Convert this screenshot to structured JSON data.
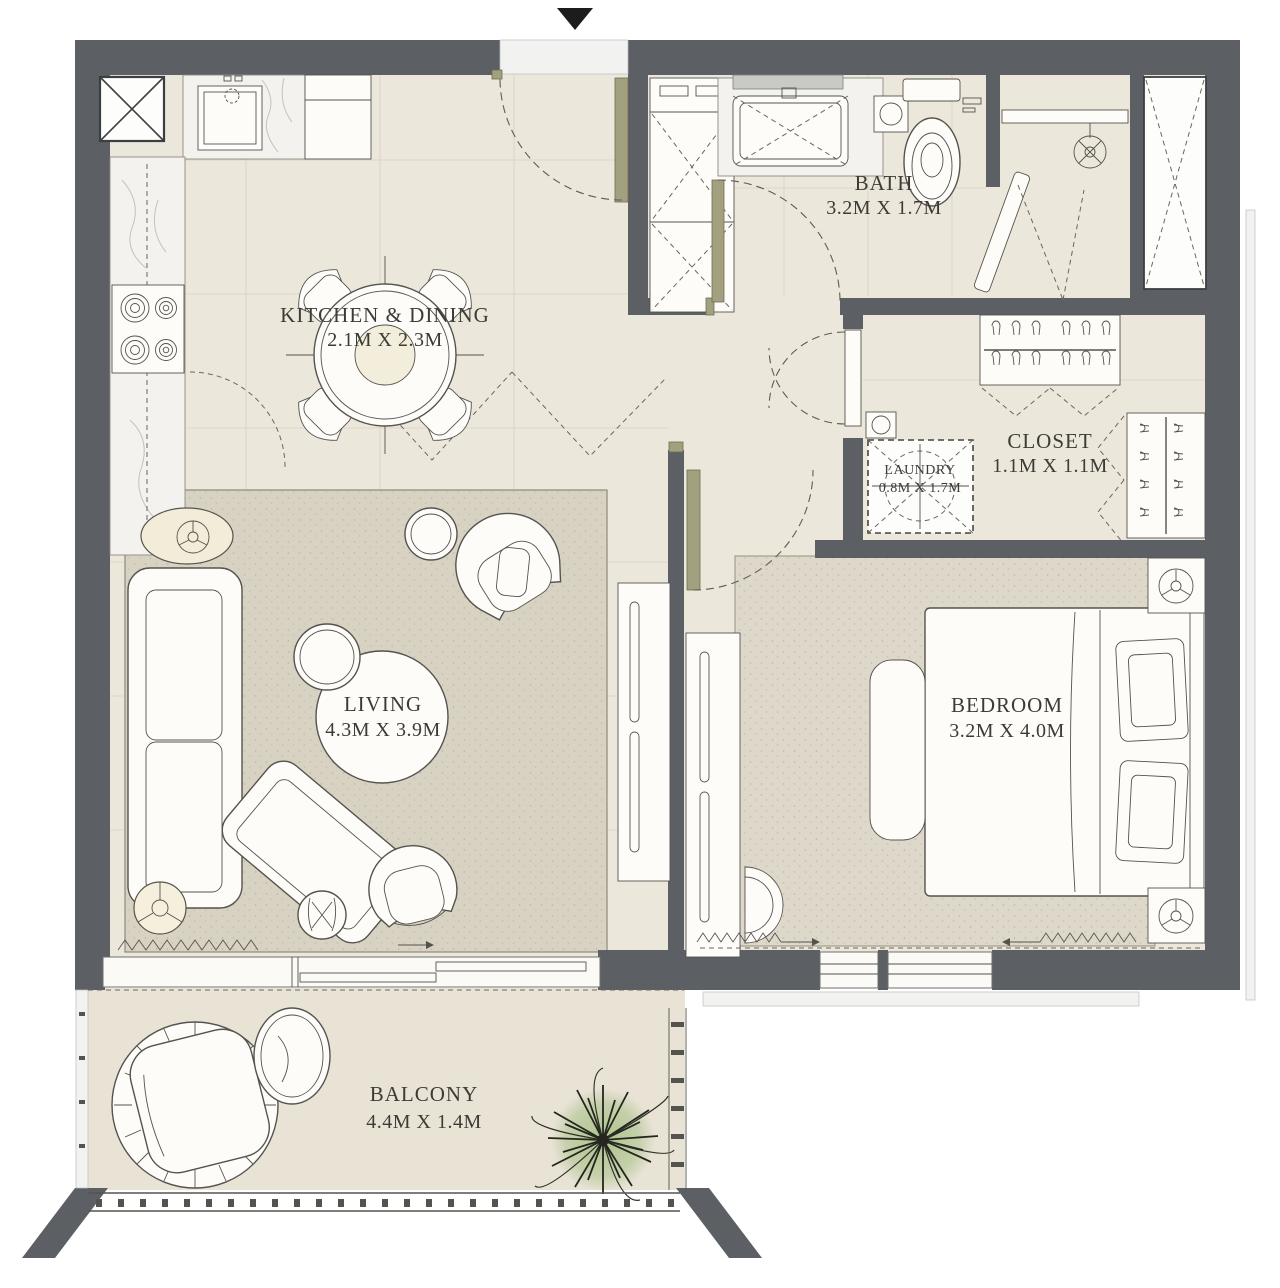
{
  "rooms": {
    "kitchen_dining": {
      "name": "KITCHEN & DINING",
      "size": "2.1M X 2.3M"
    },
    "bath": {
      "name": "BATH",
      "size": "3.2M X 1.7M"
    },
    "closet": {
      "name": "CLOSET",
      "size": "1.1M X 1.1M"
    },
    "laundry": {
      "name": "LAUNDRY",
      "size": "0.8M X 1.7M"
    },
    "living": {
      "name": "LIVING",
      "size": "4.3M X 3.9M"
    },
    "bedroom": {
      "name": "BEDROOM",
      "size": "3.2M X 4.0M"
    },
    "balcony": {
      "name": "BALCONY",
      "size": "4.4M X 1.4M"
    }
  },
  "icons": {
    "entry_arrow": "filled-down-triangle"
  },
  "colors": {
    "wall": "#5c6064",
    "floor": "#ece7db",
    "floor_balcony": "#e9e3d6",
    "rug_living": "#d8d2c3",
    "rug_bedroom": "#ded8ca",
    "marble": "#f4f2ee",
    "furniture": "#fdfcf8",
    "outline": "#55534e",
    "door": "#a2a07f",
    "plant": "#a9c188",
    "text": "#3d3b36"
  }
}
